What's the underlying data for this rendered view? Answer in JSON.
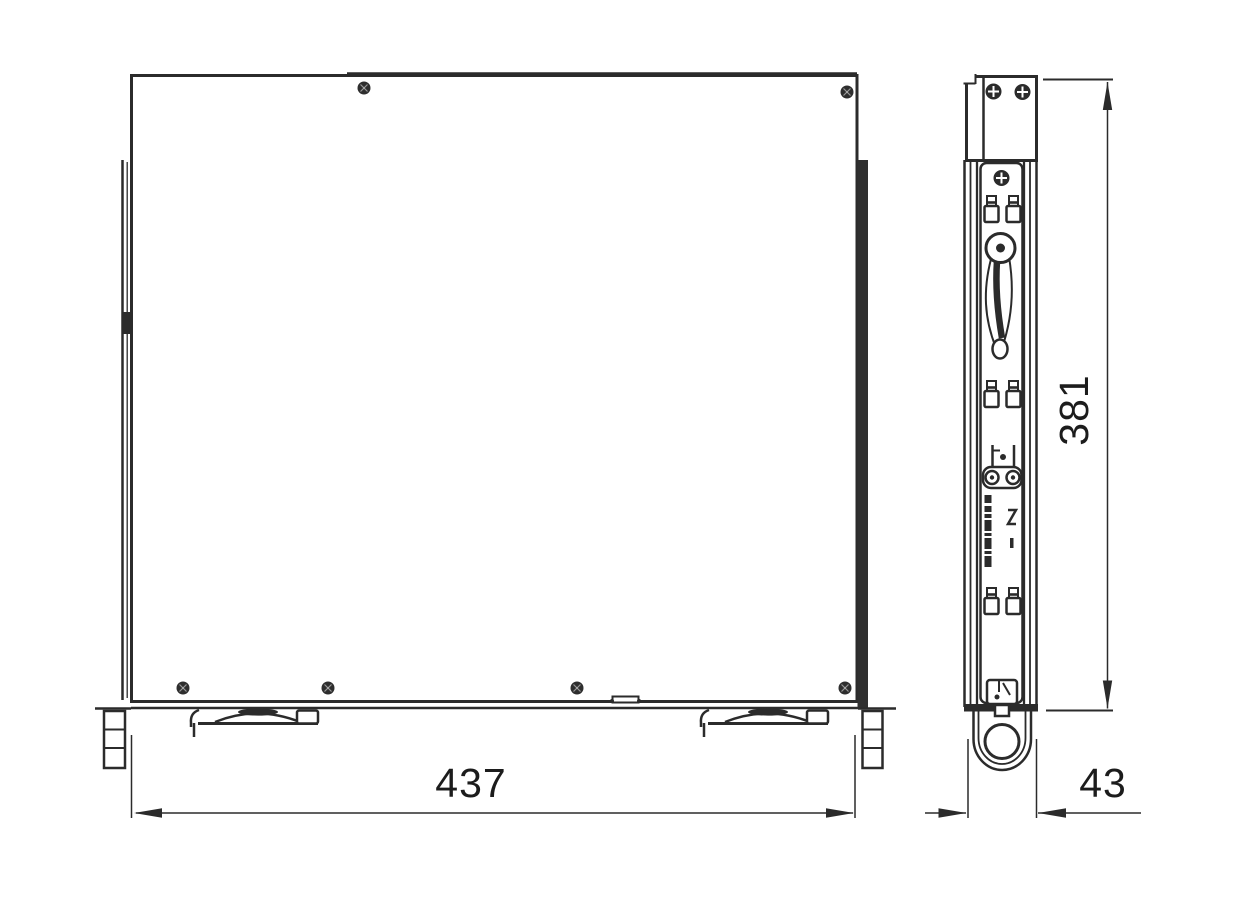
{
  "dimensions": {
    "width": "437",
    "height": "381",
    "depth": "43"
  },
  "colors": {
    "line": "#2b2b2b",
    "background": "#ffffff",
    "text": "#1c1c1c"
  }
}
